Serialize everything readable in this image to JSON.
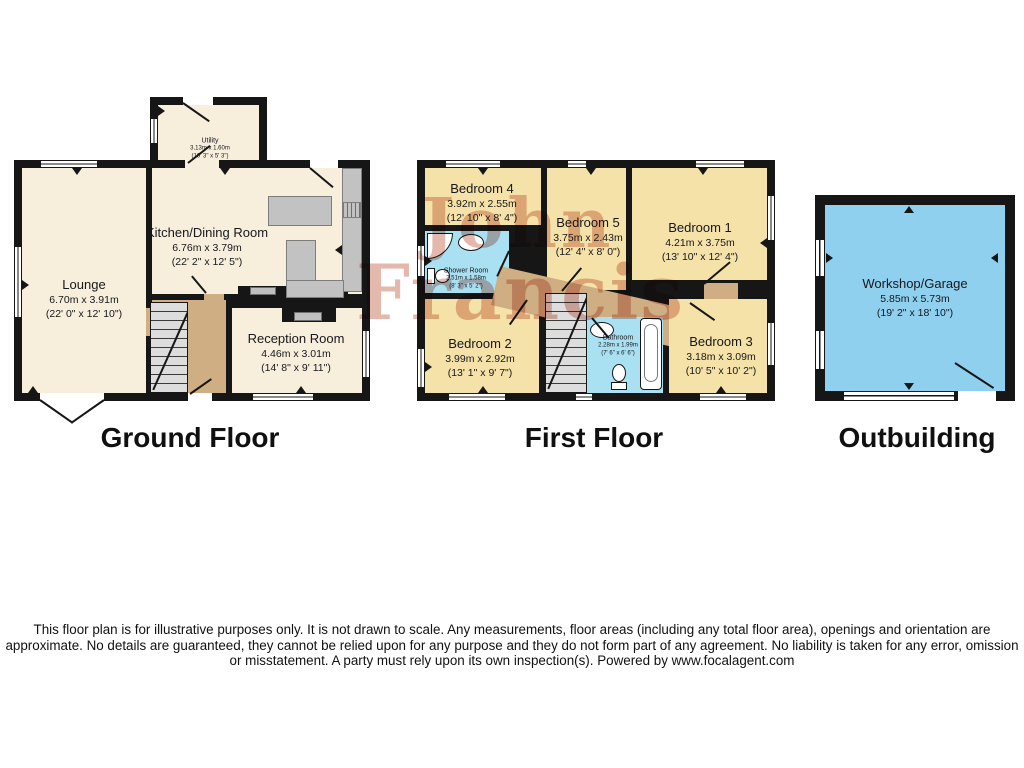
{
  "floors": [
    {
      "label": "Ground Floor",
      "rooms": [
        {
          "name": "Utility",
          "metric": "3.13m x 1.60m",
          "imperial": "(10' 3\" x 5' 3\")"
        },
        {
          "name": "Kitchen/Dining Room",
          "metric": "6.76m x 3.79m",
          "imperial": "(22' 2\" x 12' 5\")"
        },
        {
          "name": "Lounge",
          "metric": "6.70m x 3.91m",
          "imperial": "(22' 0\" x 12' 10\")"
        },
        {
          "name": "Reception Room",
          "metric": "4.46m x 3.01m",
          "imperial": "(14' 8\" x 9' 11\")"
        }
      ]
    },
    {
      "label": "First Floor",
      "rooms": [
        {
          "name": "Bedroom 4",
          "metric": "3.92m x 2.55m",
          "imperial": "(12' 10\" x 8' 4\")"
        },
        {
          "name": "Bedroom 5",
          "metric": "3.75m x 2.43m",
          "imperial": "(12' 4\" x 8' 0\")"
        },
        {
          "name": "Bedroom 1",
          "metric": "4.21m x 3.75m",
          "imperial": "(13' 10\" x 12' 4\")"
        },
        {
          "name": "Shower Room",
          "metric": "2.51m x 1.58m",
          "imperial": "(8' 3\" x 5' 2\")"
        },
        {
          "name": "Bedroom 2",
          "metric": "3.99m x 2.92m",
          "imperial": "(13' 1\" x 9' 7\")"
        },
        {
          "name": "Bathroom",
          "metric": "2.28m x 1.99m",
          "imperial": "(7' 6\" x 6' 6\")"
        },
        {
          "name": "Bedroom 3",
          "metric": "3.18m x 3.09m",
          "imperial": "(10' 5\" x 10' 2\")"
        }
      ]
    },
    {
      "label": "Outbuilding",
      "rooms": [
        {
          "name": "Workshop/Garage",
          "metric": "5.85m x 5.73m",
          "imperial": "(19' 2\" x 18' 10\")"
        }
      ]
    }
  ],
  "watermark": {
    "line1": "John",
    "line2": "Francis"
  },
  "disclaimer": "This floor plan is for illustrative purposes only. It is not drawn to scale. Any measurements, floor areas (including any total floor area), openings and orientation are approximate. No details are guaranteed, they cannot be relied upon for any purpose and they do not form part of any agreement. No liability is taken for any error, omission or misstatement. A party must rely upon its own inspection(s). Powered by www.focalagent.com",
  "colors": {
    "wall": "#161616",
    "ground_floor_room": "#F7EFDB",
    "first_floor_room": "#F5E2A8",
    "hallway": "#CFAE83",
    "wet_room": "#A9E0F2",
    "outbuilding_room": "#8FD0EF",
    "counter_gray": "#C2C2C2",
    "watermark_red": "#C0543E"
  }
}
